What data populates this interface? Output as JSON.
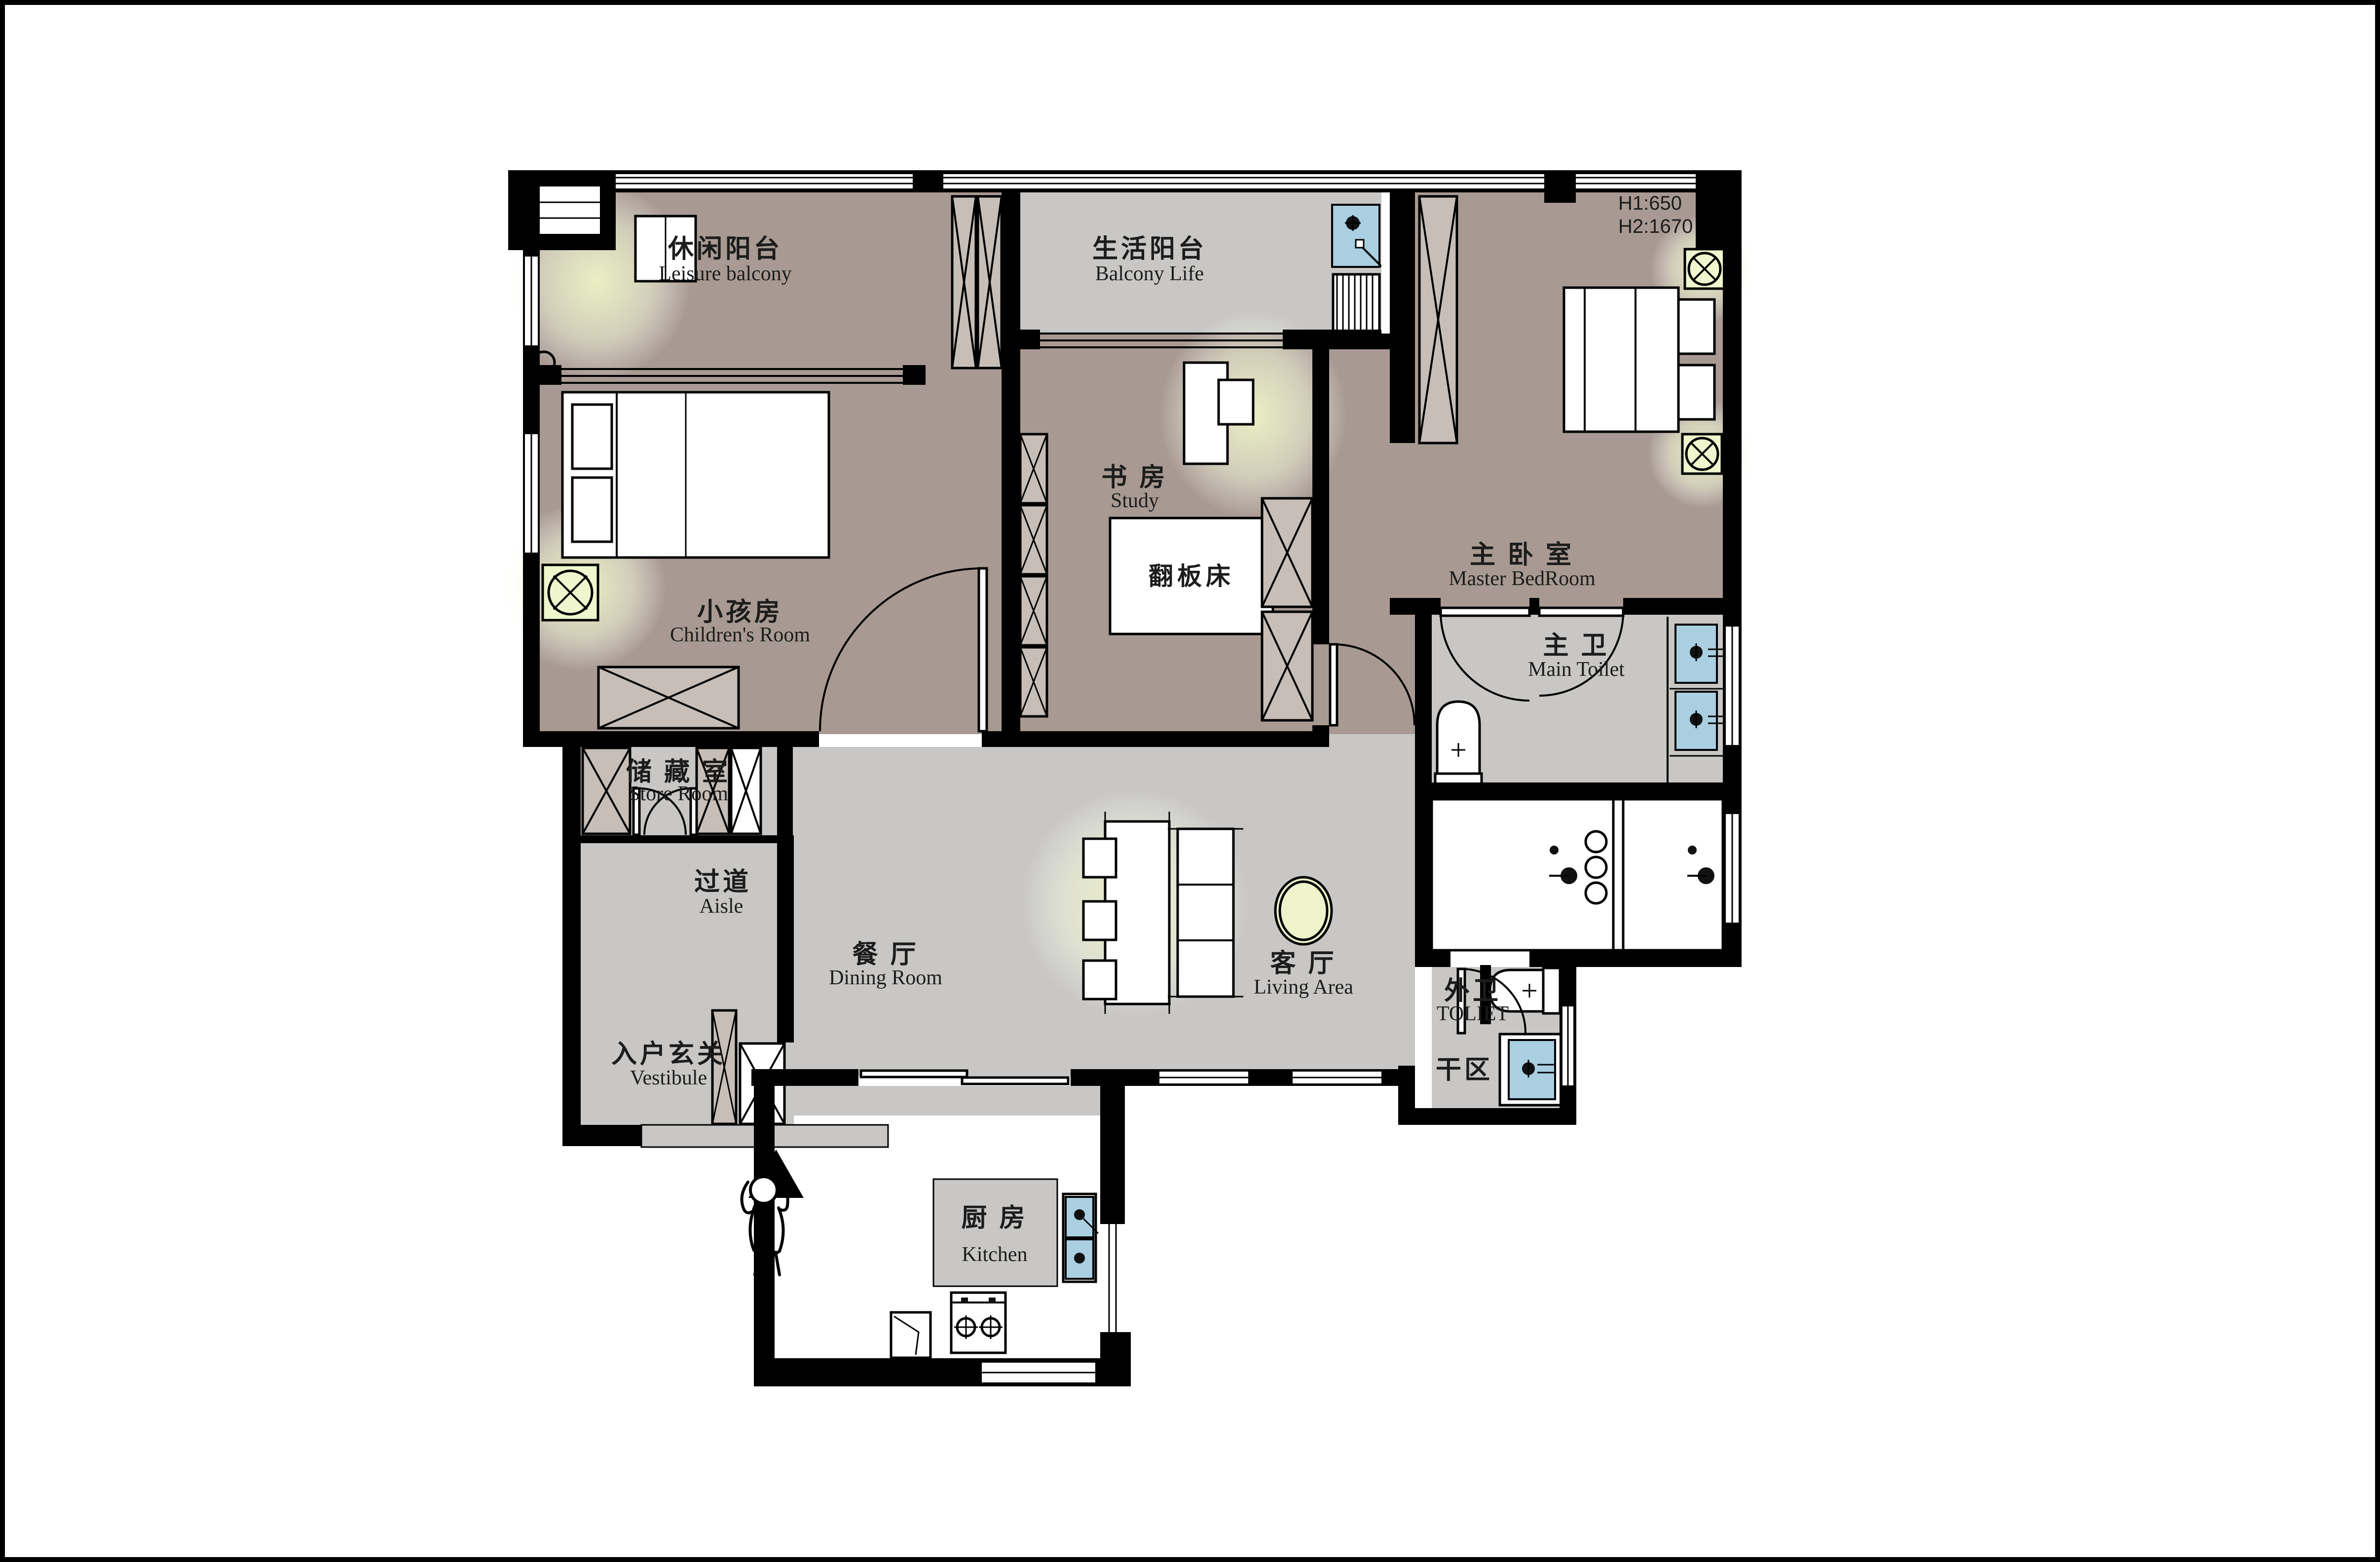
{
  "title": "apartment-floor-plan",
  "colors": {
    "wall": "#000000",
    "floor_warm": "#a89a92",
    "floor_gray": "#c8c7c5",
    "cabinet_fill": "#c6beb7",
    "fixture_blue": "#a9cfe1",
    "lamp_yellow": "#eff5cd",
    "glow": "#eef3c8",
    "paper": "#ffffff"
  },
  "rooms": {
    "leisure": {
      "cn": "休闲阳台",
      "en": "Leisure balcony"
    },
    "balcony_life": {
      "cn": "生活阳台",
      "en": "Balcony Life"
    },
    "children": {
      "cn": "小孩房",
      "en": "Children's Room"
    },
    "study": {
      "cn": "书 房",
      "en": "Study"
    },
    "master": {
      "cn": "主 卧 室",
      "en": "Master BedRoom"
    },
    "main_toilet": {
      "cn": "主 卫",
      "en": "Main Toilet"
    },
    "store": {
      "cn": "储 藏 室",
      "en": "Store Room"
    },
    "aisle": {
      "cn": "过道",
      "en": "Aisle"
    },
    "dining": {
      "cn": "餐 厅",
      "en": "Dining Room"
    },
    "living": {
      "cn": "客 厅",
      "en": "Living Area"
    },
    "outer_toilet": {
      "cn": "外卫",
      "en": "TOLIET"
    },
    "dry_area": {
      "cn": "干区"
    },
    "vestibule": {
      "cn": "入户玄关",
      "en": "Vestibule"
    },
    "kitchen": {
      "cn": "厨 房",
      "en": "Kitchen"
    }
  },
  "notes": {
    "h1": "H1:650",
    "h2": "H2:1670",
    "flip_bed": "翻板床"
  }
}
